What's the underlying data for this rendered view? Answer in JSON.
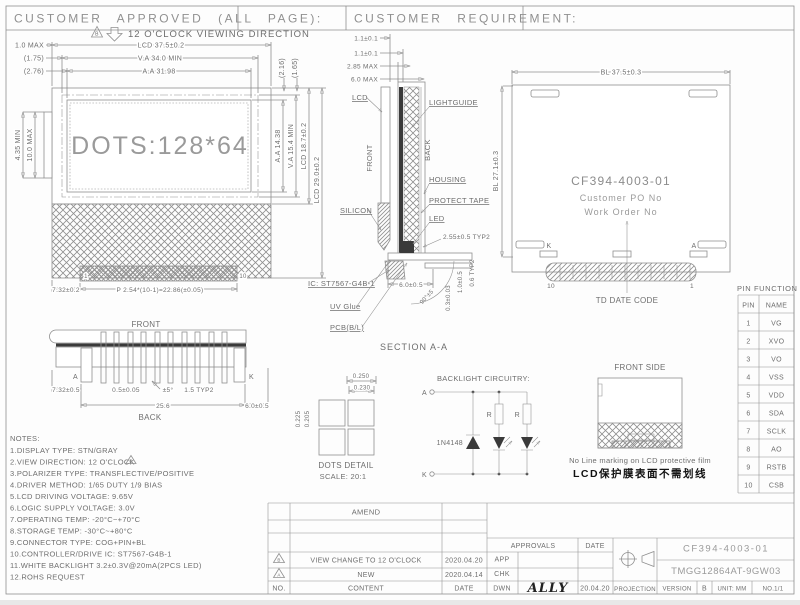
{
  "colors": {
    "line": "#8f8f8f",
    "text": "#6e6e6e",
    "dark": "#2a2a2a",
    "paper": "#ffffff"
  },
  "header": {
    "approved": "CUSTOMER APPROVED (ALL PAGE):",
    "requirement": "CUSTOMER REQUIREMENT:"
  },
  "viewing": {
    "mark": "B",
    "label": "12 O'CLOCK VIEWING DIRECTION"
  },
  "front_view": {
    "display": "DOTS:128*64",
    "dim_lcd_w": "LCD 37.5±0.2",
    "dim_va_w": "V.A 34.0 MIN",
    "dim_aa_w": "A.A 31.98",
    "dim_1_0": "1.0 MAX",
    "dim_175": "(1.75)",
    "dim_276": "(2.76)",
    "dim_216": "(2.16)",
    "dim_165": "(1.65)",
    "dim_435": "4.35 MIN",
    "dim_100": "10.0 MAX",
    "dim_aa_h": "A.A 14.38",
    "dim_va_h": "V.A 15.4 MIN",
    "dim_lcd_h": "LCD 18.7±0.2",
    "dim_lcd_h2": "LCD 29.0±0.2",
    "dim_732": "7.32±0.2",
    "dim_pitch": "P 2.54*(10-1)=22.86(±0.05)",
    "pin_first": "1",
    "pin_last": "10"
  },
  "section_aa": {
    "title": "SECTION A-A",
    "dim_t1": "1.1±0.1",
    "dim_t2": "1.1±0.1",
    "dim_t3": "2.85 MAX",
    "dim_t4": "6.0 MAX",
    "lbl_lcd": "LCD",
    "lbl_front": "FRONT",
    "lbl_back": "BACK",
    "lbl_lightguide": "LIGHTGUIDE",
    "lbl_housing": "HOUSING",
    "lbl_protect": "PROTECT TAPE",
    "lbl_led": "LED",
    "lbl_silicon": "SILICON",
    "dim_255": "2.55±0.5 TYP2",
    "lbl_ic": "IC: ST7567-G4B-1",
    "lbl_uv": "UV Glue",
    "lbl_pcb": "PCB(B/L)",
    "dim_60": "6.0±0.5",
    "dim_03": "0.3±0.03",
    "dim_10": "1.0±0.5",
    "dim_06": "0.6 TYP2",
    "dim_angle": "90°±5"
  },
  "back_view": {
    "dim_w": "BL 37.5±0.3",
    "dim_h": "BL 27.1±0.3",
    "part_no": "CF394-4003-01",
    "po": "Customer PO No",
    "wo": "Work Order No",
    "date_code": "TD DATE CODE",
    "k": "K",
    "a": "A",
    "pin10": "10",
    "pin1": "1"
  },
  "pin_view": {
    "front": "FRONT",
    "back": "BACK",
    "a": "A",
    "k": "K",
    "dim_732": "7.32±0.5",
    "dim_05": "0.5±0.05",
    "dim_angle": "±5°",
    "dim_15": "1.5 TYP2",
    "dim_256": "25.6",
    "dim_60": "6.0±0.5"
  },
  "dots_detail": {
    "dim_250": "0.250",
    "dim_230": "0.230",
    "dim_225": "0.225",
    "dim_205": "0.205",
    "title": "DOTS DETAIL",
    "scale": "SCALE: 20:1"
  },
  "backlight": {
    "title": "BACKLIGHT CIRCUITRY:",
    "a": "A",
    "k": "K",
    "diode": "1N4148",
    "r1": "R",
    "r2": "R"
  },
  "front_side": {
    "title": "FRONT SIDE",
    "note_en": "No Line marking on LCD protective film",
    "note_cn": "LCD保护膜表面不需划线"
  },
  "pin_table": {
    "title": "PIN FUNCTION",
    "col_pin": "PIN",
    "col_name": "NAME",
    "rows": [
      {
        "pin": "1",
        "name": "VG"
      },
      {
        "pin": "2",
        "name": "XVO"
      },
      {
        "pin": "3",
        "name": "VO"
      },
      {
        "pin": "4",
        "name": "VSS"
      },
      {
        "pin": "5",
        "name": "VDD"
      },
      {
        "pin": "6",
        "name": "SDA"
      },
      {
        "pin": "7",
        "name": "SCLK"
      },
      {
        "pin": "8",
        "name": "AO"
      },
      {
        "pin": "9",
        "name": "RSTB"
      },
      {
        "pin": "10",
        "name": "CSB"
      }
    ]
  },
  "notes": {
    "title": "NOTES:",
    "mark": "B",
    "items": [
      "1.DISPLAY TYPE: STN/GRAY",
      "2.VIEW DIRECTION: 12 O'CLOCK",
      "3.POLARIZER TYPE: TRANSFLECTIVE/POSITIVE",
      "4.DRIVER METHOD: 1/65 DUTY 1/9 BIAS",
      "5.LCD DRIVING VOLTAGE: 9.65V",
      "6.LOGIC SUPPLY VOLTAGE: 3.0V",
      "7.OPERATING TEMP: -20°C~+70°C",
      "8.STORAGE TEMP: -30°C~+80°C",
      "9.CONNECTOR TYPE: COG+PIN+BL",
      "10.CONTROLLER/DRIVE IC: ST7567-G4B-1",
      "11.WHITE BACKLIGHT 3.2±0.3V@20mA(2PCS LED)",
      "12.ROHS REQUEST"
    ]
  },
  "title_block": {
    "amend": "AMEND",
    "rows": [
      {
        "mark": "B",
        "content": "VIEW CHANGE TO 12 O'CLOCK",
        "date": "2020.04.20"
      },
      {
        "mark": "A",
        "content": "NEW",
        "date": "2020.04.14"
      }
    ],
    "no": "NO.",
    "content": "CONTENT",
    "date": "DATE",
    "approvals": "APPROVALS",
    "date_lbl": "DATE",
    "app": "APP",
    "chk": "CHK",
    "dwn": "DWN",
    "dwn_sign": "ALLY",
    "dwn_date": "20.04.20",
    "projection": "PROJECTION",
    "part_no": "CF394-4003-01",
    "model": "TMGG12864AT-9GW03",
    "version_lbl": "VERSION",
    "version": "B",
    "unit": "UNIT: MM",
    "page": "NO.1/1"
  }
}
